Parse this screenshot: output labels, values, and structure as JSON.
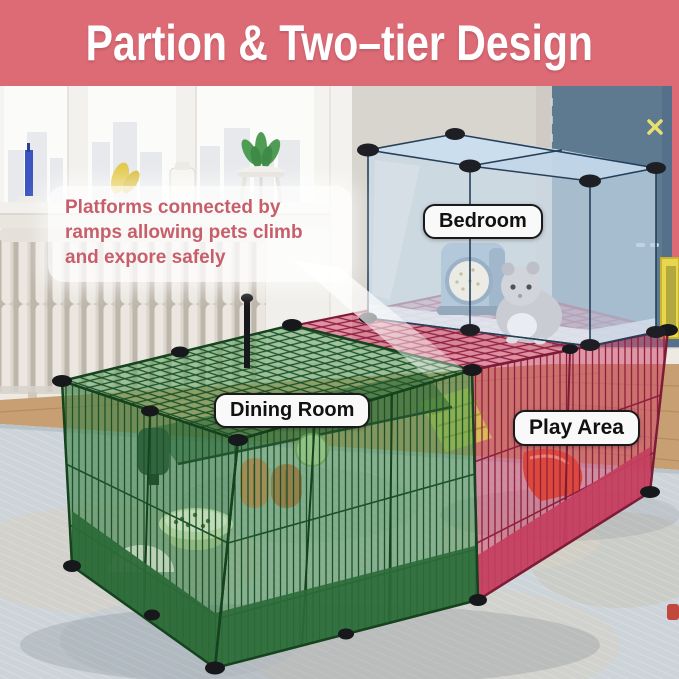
{
  "banner": {
    "title": "Partion & Two–tier Design"
  },
  "callout": {
    "line1": "Platforms connected by",
    "line2": "ramps allowing pets climb",
    "line3": "and expore safely"
  },
  "room_labels": {
    "bedroom": "Bedroom",
    "dining_room": "Dining Room",
    "play_area": "Play Area"
  },
  "colors": {
    "banner_bg": "#dd6b76",
    "banner_text": "#ffffff",
    "callout_text": "#c75f6b",
    "label_bg": "#f9f9f9",
    "label_border": "#1a1a1a",
    "label_text": "#111111",
    "green_section": "#2c6b38",
    "pink_section": "#cf4566",
    "blue_cube": "#b9cfe2",
    "blue_wall": "#5d7a91",
    "wood_floor": "#c79f73",
    "rug": "#cdd4d9"
  }
}
